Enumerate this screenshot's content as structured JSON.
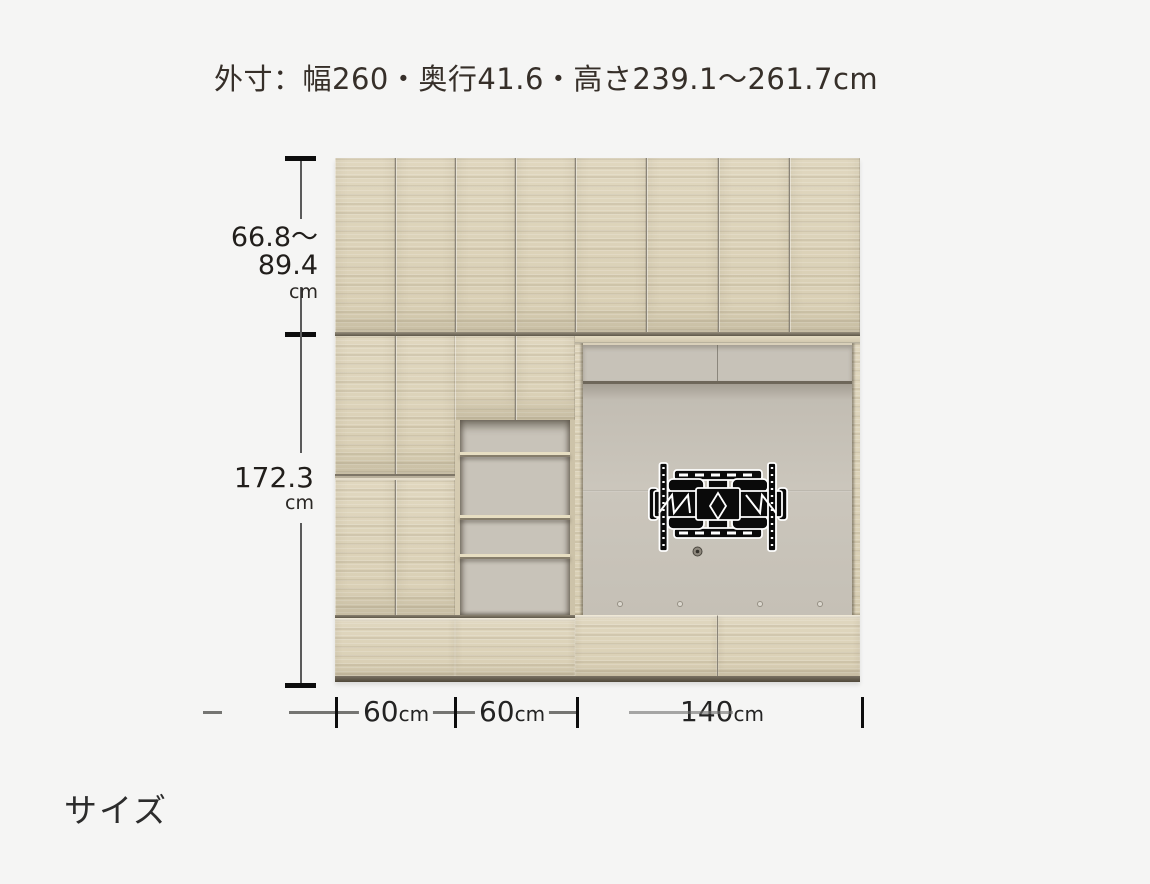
{
  "title": "外寸：幅260・奥行41.6・高さ239.1〜261.7cm",
  "section_label": "サイズ",
  "diagram": {
    "height_upper": {
      "value": "66.8〜89.4",
      "unit": "cm"
    },
    "height_lower": {
      "value": "172.3",
      "unit": "cm"
    },
    "width_segments": [
      {
        "value": "60",
        "unit": "cm"
      },
      {
        "value": "60",
        "unit": "cm"
      },
      {
        "value": "140",
        "unit": "cm"
      }
    ],
    "colors": {
      "background": "#f5f5f4",
      "wood": "#dcd2b8",
      "recess_back": "#c8c3b9",
      "valance": "#c7c2b8",
      "plinth": "#655d4d",
      "dimension_line": "#757572",
      "dimension_cap": "#0d0d0d",
      "text": "#362f29"
    }
  }
}
